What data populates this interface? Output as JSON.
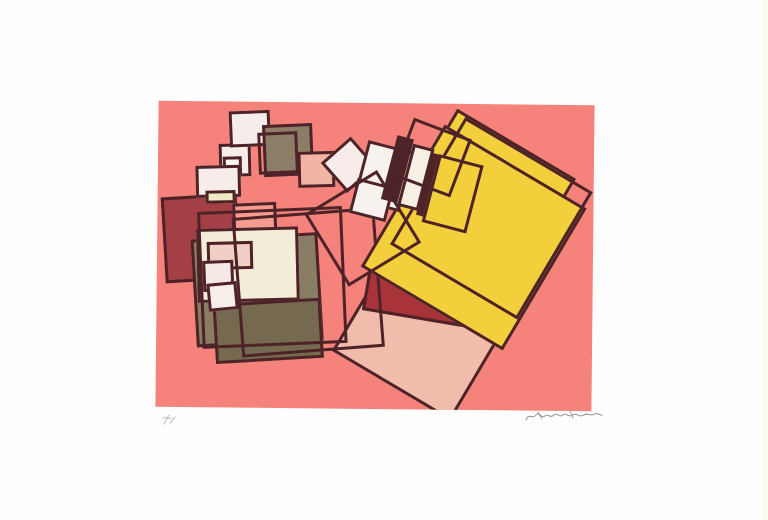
{
  "artwork": {
    "canvas": {
      "left": 157,
      "top": 103,
      "width": 436,
      "height": 306,
      "background": "#F5837B",
      "outline_color": "#4E2328",
      "stroke_width": 3
    },
    "palette": {
      "salmon_field": "#F5837B",
      "dark_outline": "#4E2328",
      "maroon": "#A43F45",
      "brick_red": "#A8343A",
      "yellow": "#F4CF3C",
      "taupe": "#8A7D65",
      "dark_taupe": "#75694F",
      "ivory": "#F3ECD8",
      "pale_white": "#F6EDEB",
      "light_pink": "#F2BCAC"
    },
    "shapes": [
      {
        "name": "maroon-square",
        "x": 6,
        "y": 94,
        "w": 76,
        "h": 86,
        "rot": -4,
        "fill": "#A43F45",
        "stroke": true
      },
      {
        "name": "salmon-light-square",
        "x": 76,
        "y": 101,
        "w": 44,
        "h": 58,
        "rot": -3,
        "fill": "#F59B90",
        "stroke": true
      },
      {
        "name": "chain-white-square-middle",
        "x": 61,
        "y": 42,
        "w": 32,
        "h": 33,
        "rot": -2,
        "fill": "#F6EDEB",
        "stroke": true
      },
      {
        "name": "chain-white-square-top",
        "x": 71,
        "y": 9,
        "w": 41,
        "h": 36,
        "rot": -3,
        "fill": "#F6EDEB",
        "stroke": true
      },
      {
        "name": "chain-taupe-square",
        "x": 105,
        "y": 22,
        "w": 50,
        "h": 52,
        "rot": -3,
        "fill": "#8C7E66",
        "stroke": true
      },
      {
        "name": "chain-tiny-white-square",
        "x": 65,
        "y": 55,
        "w": 19,
        "h": 20,
        "rot": -2,
        "fill": "#FBF5F2",
        "stroke": true
      },
      {
        "name": "chain-white-square-bottom",
        "x": 38,
        "y": 64,
        "w": 45,
        "h": 32,
        "rot": -2,
        "fill": "#F6EDEB",
        "stroke": true
      },
      {
        "name": "cream-strip",
        "x": 48,
        "y": 89,
        "w": 30,
        "h": 13,
        "rot": -2,
        "fill": "#EFEAC4",
        "stroke": true
      },
      {
        "name": "chain-pink-square",
        "x": 140,
        "y": 49,
        "w": 37,
        "h": 36,
        "rot": -2,
        "fill": "#F2B4A4",
        "stroke": true
      },
      {
        "name": "chain-outline-square",
        "x": 100,
        "y": 30,
        "w": 40,
        "h": 42,
        "rot": -3,
        "fill": null,
        "stroke": true
      },
      {
        "name": "taupe-big-square",
        "x": 37,
        "y": 134,
        "w": 127,
        "h": 108,
        "rot": -4,
        "fill": "#8A7D65",
        "stroke": true
      },
      {
        "name": "ivory-big-square",
        "x": 40,
        "y": 126,
        "w": 102,
        "h": 74,
        "rot": -2,
        "fill": "#F3ECD8",
        "stroke": true
      },
      {
        "name": "pink-pale-square",
        "x": 50,
        "y": 140,
        "w": 46,
        "h": 28,
        "rot": -2,
        "fill": "#F1CFC5",
        "stroke": true
      },
      {
        "name": "white-pale-square",
        "x": 46,
        "y": 159,
        "w": 31,
        "h": 31,
        "rot": -3,
        "fill": "#F6E9E5",
        "stroke": true
      },
      {
        "name": "taupe-dark-square",
        "x": 58,
        "y": 199,
        "w": 108,
        "h": 60,
        "rot": -4,
        "fill": "#75694F",
        "stroke": true
      },
      {
        "name": "white-small-square",
        "x": 51,
        "y": 181,
        "w": 30,
        "h": 28,
        "rot": -6,
        "fill": "#F7EDE9",
        "stroke": true
      },
      {
        "name": "pink-big-square",
        "x": 201,
        "y": 154,
        "w": 138,
        "h": 138,
        "rot": 30,
        "fill": "#F2BCAC",
        "stroke": true
      },
      {
        "name": "pale-small-square",
        "x": 235,
        "y": 139,
        "w": 40,
        "h": 40,
        "rot": 30,
        "fill": "#F7EFE9",
        "stroke": true
      },
      {
        "name": "brick-red-band",
        "x": 209,
        "y": 162,
        "w": 135,
        "h": 56,
        "rot": 9,
        "fill": "#A8343A",
        "stroke": true
      },
      {
        "name": "outline-square-left",
        "x": 43,
        "y": 107,
        "w": 145,
        "h": 137,
        "rot": -3,
        "fill": null,
        "stroke": true
      },
      {
        "name": "outline-square-right",
        "x": 80,
        "y": 110,
        "w": 143,
        "h": 140,
        "rot": -5,
        "fill": null,
        "stroke": true
      },
      {
        "name": "yellow-back-square",
        "x": 255,
        "y": 30,
        "w": 138,
        "h": 138,
        "rot": 30,
        "fill": "#F4CF3C",
        "stroke": true
      },
      {
        "name": "yellow-big-square",
        "x": 234,
        "y": 51,
        "w": 165,
        "h": 165,
        "rot": 30,
        "fill": "#F4CF3C",
        "stroke": true
      },
      {
        "name": "yellow-outline-square",
        "x": 260,
        "y": 40,
        "w": 148,
        "h": 148,
        "rot": 30,
        "fill": null,
        "stroke": true
      },
      {
        "name": "ladder-pale-diamond",
        "x": 171,
        "y": 42,
        "w": 40,
        "h": 40,
        "rot": -42,
        "fill": "#F7ECEA",
        "stroke": true
      },
      {
        "name": "ladder-white-square",
        "x": 202,
        "y": 42,
        "w": 48,
        "h": 62,
        "rot": 14,
        "fill": "#F8F2EE",
        "stroke": true
      },
      {
        "name": "ladder-white-square-lower",
        "x": 195,
        "y": 79,
        "w": 38,
        "h": 36,
        "rot": 14,
        "fill": "#F8F2EE",
        "stroke": true
      },
      {
        "name": "ladder-dark-band-1",
        "x": 231,
        "y": 33,
        "w": 17,
        "h": 66,
        "rot": 14,
        "fill": "#4F2429",
        "stroke": false
      },
      {
        "name": "ladder-cream-band",
        "x": 247,
        "y": 42,
        "w": 22,
        "h": 64,
        "rot": 14,
        "fill": "#F6EFE3",
        "stroke": true
      },
      {
        "name": "ladder-dark-band-2",
        "x": 266,
        "y": 50,
        "w": 15,
        "h": 64,
        "rot": 14,
        "fill": "#4F2429",
        "stroke": false
      },
      {
        "name": "ladder-yellow-square",
        "x": 272,
        "y": 55,
        "w": 46,
        "h": 70,
        "rot": 14,
        "fill": "#F4CF3C",
        "stroke": true
      },
      {
        "name": "ladder-outline-square",
        "x": 243,
        "y": 23,
        "w": 62,
        "h": 62,
        "rot": 20,
        "fill": null,
        "stroke": true
      },
      {
        "name": "crossing-outline-square",
        "x": 163,
        "y": 83,
        "w": 85,
        "h": 85,
        "rot": -32,
        "fill": null,
        "stroke": true
      }
    ]
  },
  "annotations": {
    "edition_mark": {
      "left": 159,
      "top": 412,
      "width": 22,
      "height": 16,
      "color": "#B9B9B0",
      "label": "pencil edition mark (illegible)"
    },
    "signature": {
      "left": 524,
      "top": 407,
      "width": 80,
      "height": 18,
      "color": "#909086",
      "label": "pencil signature (illegible)"
    }
  }
}
